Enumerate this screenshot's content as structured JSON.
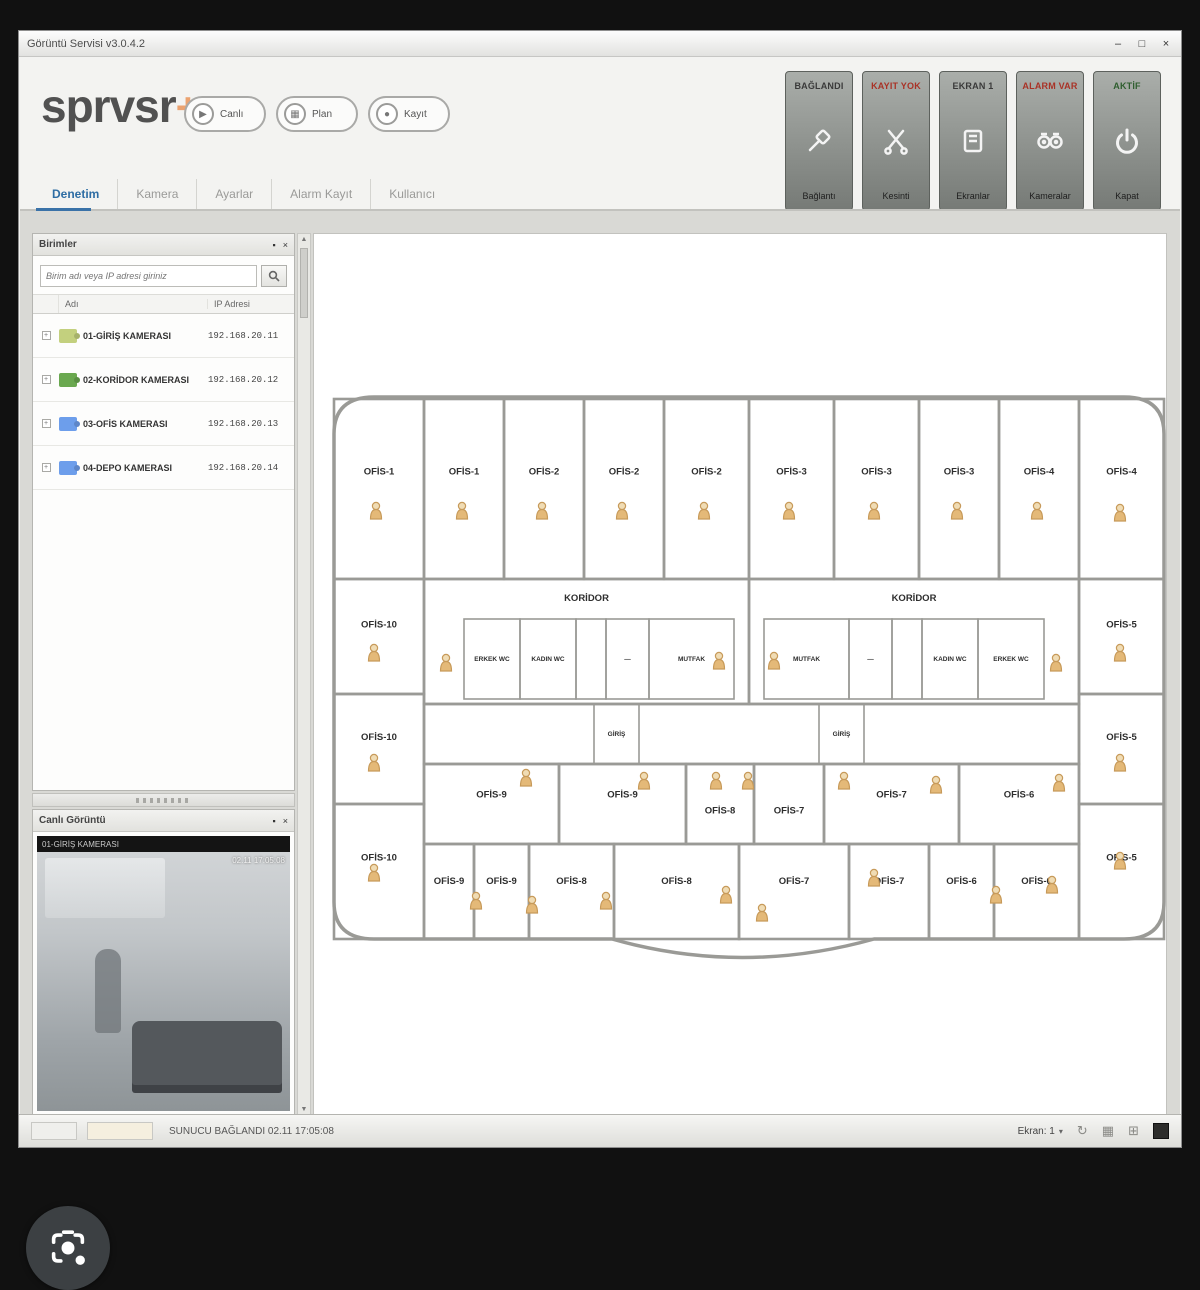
{
  "window": {
    "title": "Görüntü Servisi v3.0.4.2",
    "controls": {
      "minimize": "–",
      "maximize": "□",
      "close": "×"
    }
  },
  "header": {
    "logo_text": "sprvsr",
    "logo_plus": "+",
    "quick": [
      {
        "label": "Canlı",
        "glyph": "▶"
      },
      {
        "label": "Plan",
        "glyph": "▦"
      },
      {
        "label": "Kayıt",
        "glyph": "●"
      }
    ],
    "tiles": [
      {
        "top": "BAĞLANDI",
        "top_color": "#3a3a3a",
        "bottom": "Bağlantı",
        "icon": "connection-icon"
      },
      {
        "top": "KAYIT YOK",
        "top_color": "#a93226",
        "bottom": "Kesinti",
        "icon": "disconnect-icon"
      },
      {
        "top": "EKRAN 1",
        "top_color": "#3a3a3a",
        "bottom": "Ekranlar",
        "icon": "display-icon"
      },
      {
        "top": "ALARM VAR",
        "top_color": "#a93226",
        "bottom": "Kameralar",
        "icon": "cameras-icon"
      },
      {
        "top": "AKTİF",
        "top_color": "#2f5e2f",
        "bottom": "Kapat",
        "icon": "power-icon"
      }
    ]
  },
  "tabs": [
    {
      "label": "Denetim",
      "active": true
    },
    {
      "label": "Kamera",
      "active": false
    },
    {
      "label": "Ayarlar",
      "active": false
    },
    {
      "label": "Alarm Kayıt",
      "active": false
    },
    {
      "label": "Kullanıcı",
      "active": false
    }
  ],
  "device_panel": {
    "title": "Birimler",
    "pin_icon": "▪",
    "close_icon": "×",
    "search_placeholder": "Birim adı veya IP adresi giriniz",
    "columns": [
      "Adı",
      "IP Adresi"
    ],
    "rows": [
      {
        "name": "01-GİRİŞ KAMERASI",
        "ip": "192.168.20.11",
        "color": "#c3d07e"
      },
      {
        "name": "02-KORİDOR KAMERASI",
        "ip": "192.168.20.12",
        "color": "#6aa84f"
      },
      {
        "name": "03-OFİS KAMERASI",
        "ip": "192.168.20.13",
        "color": "#6d9eeb"
      },
      {
        "name": "04-DEPO KAMERASI",
        "ip": "192.168.20.14",
        "color": "#6d9eeb"
      }
    ]
  },
  "video_panel": {
    "title": "Canlı Görüntü",
    "pin_icon": "▪",
    "close_icon": "×",
    "camera_name": "01-GİRİŞ KAMERASI",
    "timestamp": "02.11 17:05:08"
  },
  "statusbar": {
    "message": "SUNUCU BAĞLANDI  02.11 17:05:08",
    "screen_label": "Ekran: 1",
    "chevron": "▾",
    "icons": [
      "↻",
      "▦",
      "⊞"
    ]
  },
  "floor_plan": {
    "wall_color": "#9a9a96",
    "label_color": "#2e2e2e",
    "camera_color": "#e4b978",
    "rooms": [
      {
        "x": 20,
        "y": 165,
        "w": 90,
        "h": 180,
        "l": "OFİS-1"
      },
      {
        "x": 110,
        "y": 165,
        "w": 80,
        "h": 180,
        "l": "OFİS-1"
      },
      {
        "x": 190,
        "y": 165,
        "w": 80,
        "h": 180,
        "l": "OFİS-2"
      },
      {
        "x": 270,
        "y": 165,
        "w": 80,
        "h": 180,
        "l": "OFİS-2"
      },
      {
        "x": 350,
        "y": 165,
        "w": 85,
        "h": 180,
        "l": "OFİS-2"
      },
      {
        "x": 435,
        "y": 165,
        "w": 85,
        "h": 180,
        "l": "OFİS-3"
      },
      {
        "x": 520,
        "y": 165,
        "w": 85,
        "h": 180,
        "l": "OFİS-3"
      },
      {
        "x": 605,
        "y": 165,
        "w": 80,
        "h": 180,
        "l": "OFİS-3"
      },
      {
        "x": 685,
        "y": 165,
        "w": 80,
        "h": 180,
        "l": "OFİS-4"
      },
      {
        "x": 765,
        "y": 165,
        "w": 85,
        "h": 180,
        "l": "OFİS-4"
      },
      {
        "x": 20,
        "y": 345,
        "w": 90,
        "h": 115,
        "l": "OFİS-10"
      },
      {
        "x": 20,
        "y": 460,
        "w": 90,
        "h": 110,
        "l": "OFİS-10"
      },
      {
        "x": 20,
        "y": 570,
        "w": 90,
        "h": 135,
        "l": "OFİS-10"
      },
      {
        "x": 765,
        "y": 345,
        "w": 85,
        "h": 115,
        "l": "OFİS-5"
      },
      {
        "x": 765,
        "y": 460,
        "w": 85,
        "h": 110,
        "l": "OFİS-5"
      },
      {
        "x": 765,
        "y": 570,
        "w": 85,
        "h": 135,
        "l": "OFİS-5"
      },
      {
        "x": 110,
        "y": 345,
        "w": 325,
        "h": 125,
        "l": "KORİDOR",
        "ly": 22
      },
      {
        "x": 435,
        "y": 345,
        "w": 330,
        "h": 125,
        "l": "KORİDOR",
        "ly": 22
      },
      {
        "x": 150,
        "y": 385,
        "w": 56,
        "h": 80,
        "l": "ERKEK WC",
        "s": 1
      },
      {
        "x": 206,
        "y": 385,
        "w": 56,
        "h": 80,
        "l": "KADIN WC",
        "s": 1
      },
      {
        "x": 262,
        "y": 385,
        "w": 30,
        "h": 80,
        "l": "",
        "s": 1
      },
      {
        "x": 292,
        "y": 385,
        "w": 43,
        "h": 80,
        "l": "—",
        "s": 1
      },
      {
        "x": 335,
        "y": 385,
        "w": 85,
        "h": 80,
        "l": "MUTFAK",
        "s": 1
      },
      {
        "x": 450,
        "y": 385,
        "w": 85,
        "h": 80,
        "l": "MUTFAK",
        "s": 1
      },
      {
        "x": 535,
        "y": 385,
        "w": 43,
        "h": 80,
        "l": "—",
        "s": 1
      },
      {
        "x": 578,
        "y": 385,
        "w": 30,
        "h": 80,
        "l": "",
        "s": 1
      },
      {
        "x": 608,
        "y": 385,
        "w": 56,
        "h": 80,
        "l": "KADIN WC",
        "s": 1
      },
      {
        "x": 664,
        "y": 385,
        "w": 66,
        "h": 80,
        "l": "ERKEK WC",
        "s": 1
      },
      {
        "x": 110,
        "y": 470,
        "w": 655,
        "h": 60,
        "l": ""
      },
      {
        "x": 280,
        "y": 470,
        "w": 45,
        "h": 60,
        "l": "GİRİŞ",
        "s": 1
      },
      {
        "x": 505,
        "y": 470,
        "w": 45,
        "h": 60,
        "l": "GİRİŞ",
        "s": 1
      },
      {
        "x": 110,
        "y": 530,
        "w": 135,
        "h": 80,
        "l": "OFİS-9"
      },
      {
        "x": 245,
        "y": 530,
        "w": 127,
        "h": 80,
        "l": "OFİS-9"
      },
      {
        "x": 372,
        "y": 530,
        "w": 68,
        "h": 80,
        "l": "OFİS-8",
        "dy": 16
      },
      {
        "x": 440,
        "y": 530,
        "w": 70,
        "h": 80,
        "l": "OFİS-7",
        "dy": 16
      },
      {
        "x": 510,
        "y": 530,
        "w": 135,
        "h": 80,
        "l": "OFİS-7"
      },
      {
        "x": 645,
        "y": 530,
        "w": 120,
        "h": 80,
        "l": "OFİS-6"
      },
      {
        "x": 110,
        "y": 610,
        "w": 50,
        "h": 95,
        "l": "OFİS-9"
      },
      {
        "x": 160,
        "y": 610,
        "w": 55,
        "h": 95,
        "l": "OFİS-9"
      },
      {
        "x": 215,
        "y": 610,
        "w": 85,
        "h": 95,
        "l": "OFİS-8"
      },
      {
        "x": 300,
        "y": 610,
        "w": 125,
        "h": 95,
        "l": "OFİS-8"
      },
      {
        "x": 425,
        "y": 610,
        "w": 110,
        "h": 95,
        "l": "OFİS-7"
      },
      {
        "x": 535,
        "y": 610,
        "w": 80,
        "h": 95,
        "l": "OFİS-7"
      },
      {
        "x": 615,
        "y": 610,
        "w": 65,
        "h": 95,
        "l": "OFİS-6"
      },
      {
        "x": 680,
        "y": 610,
        "w": 85,
        "h": 95,
        "l": "OFİS-6"
      }
    ],
    "cameras": [
      [
        62,
        278
      ],
      [
        148,
        278
      ],
      [
        228,
        278
      ],
      [
        308,
        278
      ],
      [
        390,
        278
      ],
      [
        475,
        278
      ],
      [
        560,
        278
      ],
      [
        643,
        278
      ],
      [
        723,
        278
      ],
      [
        806,
        280
      ],
      [
        60,
        420
      ],
      [
        60,
        530
      ],
      [
        60,
        640
      ],
      [
        806,
        420
      ],
      [
        806,
        530
      ],
      [
        806,
        628
      ],
      [
        132,
        430
      ],
      [
        405,
        428
      ],
      [
        460,
        428
      ],
      [
        742,
        430
      ],
      [
        212,
        545
      ],
      [
        330,
        548
      ],
      [
        402,
        548
      ],
      [
        434,
        548
      ],
      [
        530,
        548
      ],
      [
        622,
        552
      ],
      [
        745,
        550
      ],
      [
        162,
        668
      ],
      [
        218,
        672
      ],
      [
        292,
        668
      ],
      [
        412,
        662
      ],
      [
        448,
        680
      ],
      [
        560,
        645
      ],
      [
        682,
        662
      ],
      [
        738,
        652
      ]
    ]
  }
}
